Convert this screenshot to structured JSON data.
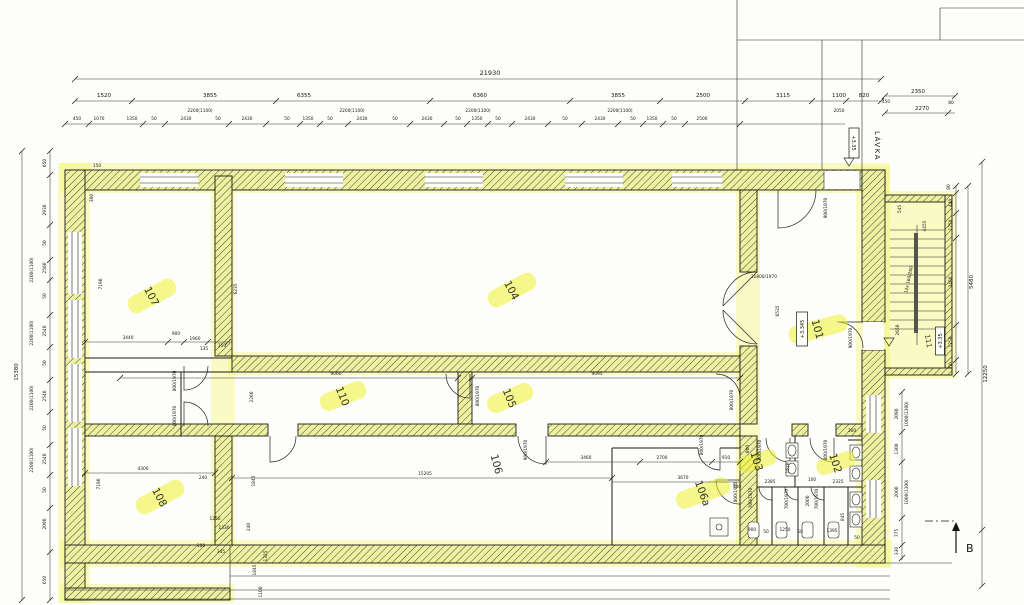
{
  "colors": {
    "highlight": "#f0f23c",
    "wall_tint": "#edf1a6",
    "ink": "#161616",
    "paper": "#fdfdfb"
  },
  "rooms": {
    "r101": "101",
    "r102": "102",
    "r103": "103",
    "r104": "104",
    "r105": "105",
    "r106": "106",
    "r106a": "106a",
    "r107": "107",
    "r108": "108",
    "r110": "110",
    "r111": "111"
  },
  "levels": {
    "lavka": "+3.35",
    "r101": "+3.345",
    "r111": "+3.35"
  },
  "labels": {
    "lavka": "LÁVKA",
    "section": "B",
    "stairs": "12x 160/280"
  },
  "doors": {
    "d800": "800/1970",
    "d900": "900/1970",
    "d700": "700/1970",
    "d2x800": "2x800/1970"
  },
  "dim": {
    "top1": "21930",
    "top2": [
      "1520",
      "3855",
      "6355",
      "6360",
      "3855",
      "2500",
      "3115",
      "1100",
      "820"
    ],
    "top2w": [
      "2200(1100)",
      "2200(1100)",
      "2200(1100)",
      "2200(1100)",
      "2050"
    ],
    "top2r": [
      "2350",
      "450",
      "2270",
      "80"
    ],
    "top3": [
      "450",
      "1070",
      "1350",
      "50",
      "2430",
      "50",
      "2430",
      "50",
      "1350",
      "50",
      "2430",
      "50",
      "2430",
      "50",
      "1350",
      "50",
      "2430",
      "50",
      "2430",
      "50",
      "1350",
      "50",
      "2500"
    ],
    "left": [
      "650",
      "2930",
      "50",
      "2560",
      "50",
      "2540",
      "50",
      "2540",
      "50",
      "2540",
      "50",
      "2090",
      "650"
    ],
    "leftw": [
      "2200(1100)",
      "2200(1100)",
      "2200(1100)",
      "2200(1100)"
    ],
    "left_total": "15380",
    "right": [
      "80",
      "440",
      "1250",
      "3480",
      "1250",
      "50"
    ],
    "right_total1": "5480",
    "right_total2": "12250",
    "stair_small": [
      "545",
      "4455",
      "2650"
    ],
    "rwin": [
      "2090",
      "1000(1300)",
      "1300",
      "2000",
      "1000(1300)",
      "775",
      "330"
    ],
    "i101": "6535",
    "i104": "6235",
    "i107": [
      "7190",
      "3440",
      "900",
      "1960",
      "135",
      "150"
    ],
    "icorner": [
      "150",
      "300"
    ],
    "i110": [
      "9060",
      "2260"
    ],
    "i105": "9095",
    "i106": [
      "15205",
      "3460",
      "2700",
      "910",
      "3670",
      "300"
    ],
    "i108": [
      "4300",
      "7190",
      "240",
      "1250",
      "1330",
      "345",
      "100"
    ],
    "iwc": [
      "2385",
      "2325",
      "900",
      "1610",
      "100",
      "2000",
      "845",
      "900",
      "50",
      "1250",
      "50",
      "1395",
      "50",
      "300"
    ],
    "ibot": [
      "1845",
      "240",
      "1325",
      "1845",
      "1100"
    ]
  }
}
